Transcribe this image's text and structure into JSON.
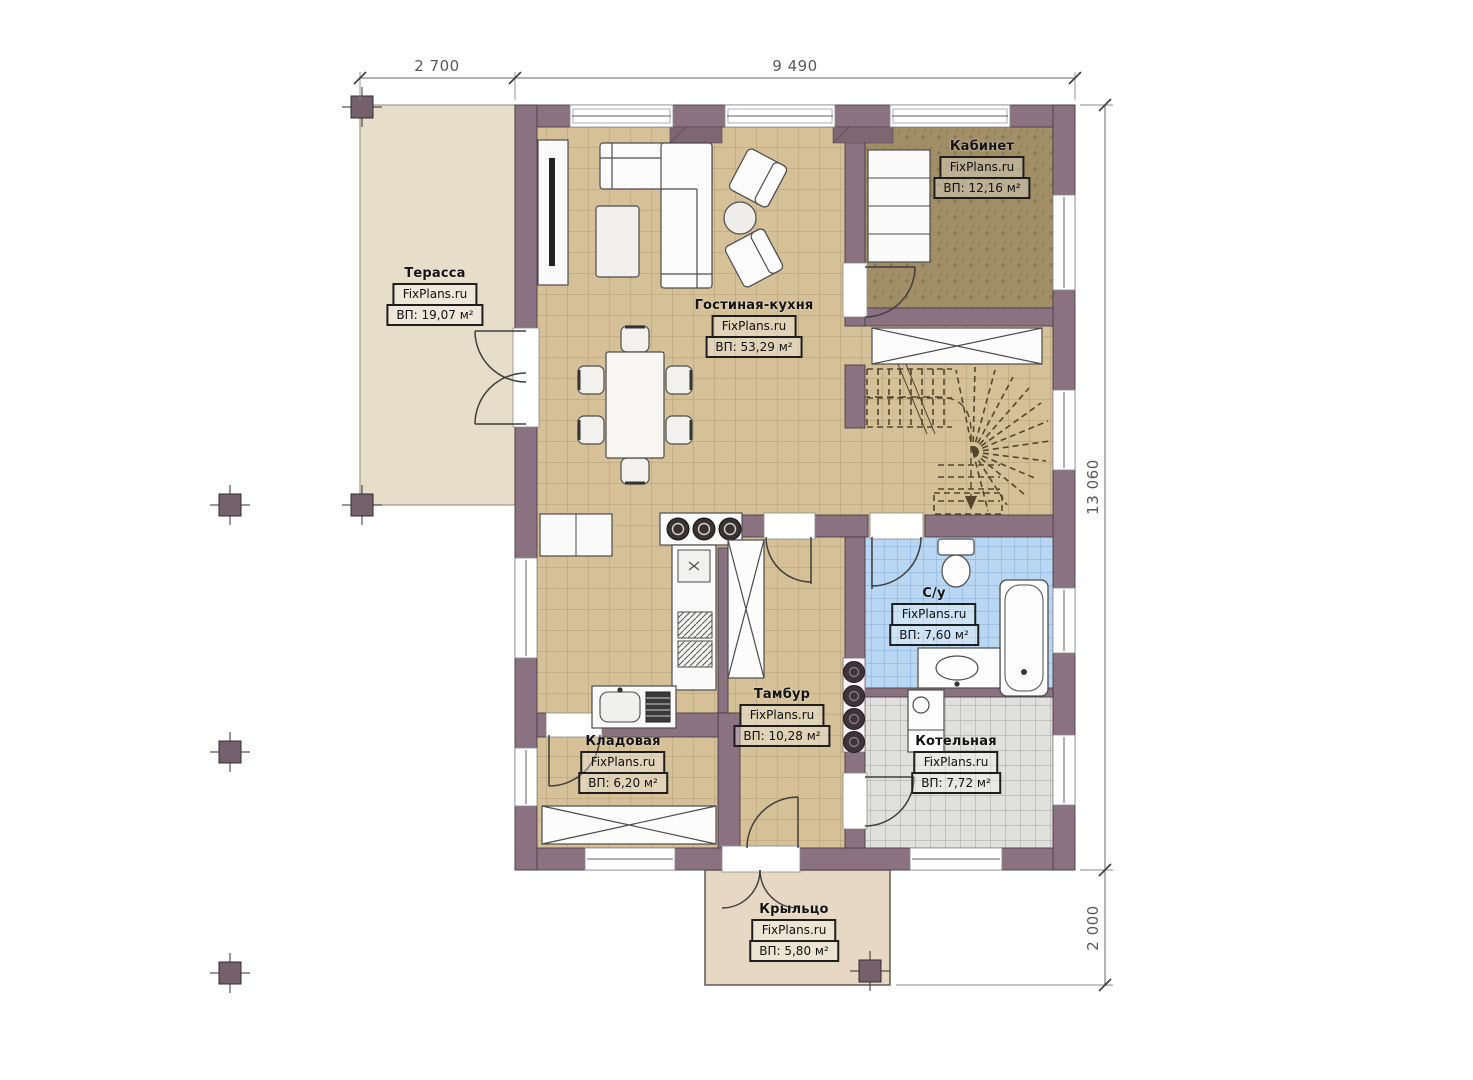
{
  "title": "План первого этажа",
  "brand": "FixPlans.ru",
  "dimensions": {
    "top_left": "2 700",
    "top_right": "9 490",
    "right_main": "13 060",
    "right_porch": "2 000"
  },
  "rooms": {
    "terrace": {
      "name": "Терасса",
      "brand": "FixPlans.ru",
      "area": "ВП: 19,07 м²"
    },
    "living": {
      "name": "Гостиная-кухня",
      "brand": "FixPlans.ru",
      "area": "ВП: 53,29 м²"
    },
    "office": {
      "name": "Кабинет",
      "brand": "FixPlans.ru",
      "area": "ВП: 12,16 м²"
    },
    "bathroom": {
      "name": "С/у",
      "brand": "FixPlans.ru",
      "area": "ВП: 7,60 м²"
    },
    "vestibule": {
      "name": "Тамбур",
      "brand": "FixPlans.ru",
      "area": "ВП: 10,28 м²"
    },
    "storage": {
      "name": "Кладовая",
      "brand": "FixPlans.ru",
      "area": "ВП: 6,20 м²"
    },
    "boiler": {
      "name": "Котельная",
      "brand": "FixPlans.ru",
      "area": "ВП: 7,72 м²"
    },
    "porch": {
      "name": "Крыльцо",
      "brand": "FixPlans.ru",
      "area": "ВП: 5,80 м²"
    }
  },
  "colors": {
    "wall": "#8b7280",
    "floor_tile_tan": "#d5c098",
    "floor_tile_blue": "#b9d7f2",
    "floor_tile_gray": "#e0e0df",
    "floor_carpet_brown": "#a18d66",
    "terrace": "#e8ddc9",
    "porch": "#e6d8c2"
  }
}
